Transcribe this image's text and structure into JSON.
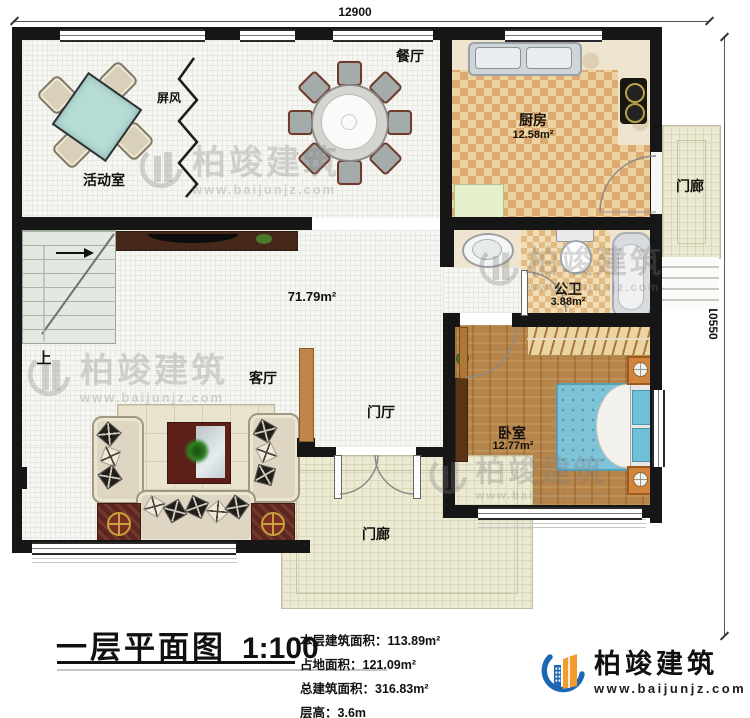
{
  "plan": {
    "title": "一层平面图",
    "scale": "1:100",
    "dimensions": {
      "top": "12900",
      "right": "10550"
    },
    "rooms": {
      "activity": {
        "label": "活动室"
      },
      "screen": {
        "label": "屏风"
      },
      "dining": {
        "label": "餐厅"
      },
      "kitchen": {
        "label": "厨房",
        "area": "12.58m²"
      },
      "porch_right": {
        "label": "门廊"
      },
      "bath": {
        "label": "公卫",
        "area": "3.88m²"
      },
      "bedroom": {
        "label": "卧室",
        "area": "12.77m²"
      },
      "living": {
        "label": "客厅"
      },
      "foyer": {
        "label": "门厅"
      },
      "porch_bottom": {
        "label": "门廊"
      },
      "stairs": {
        "label": "上"
      },
      "open_area": {
        "area": "71.79m²"
      }
    }
  },
  "footer": {
    "stats": [
      {
        "label": "本层建筑面积：",
        "value": "113.89m²"
      },
      {
        "label": "占地面积：",
        "value": "121.09m²"
      },
      {
        "label": "总建筑面积：",
        "value": "316.83m²"
      },
      {
        "label": "层高：",
        "value": "3.6m"
      }
    ]
  },
  "brand": {
    "name": "柏竣建筑",
    "url": "www.baijunjz.com"
  },
  "colors": {
    "wall": "#161616",
    "kitchen_floor": "#dcab72",
    "bedroom_floor": "#b5854b",
    "porch_floor": "#ecead3",
    "table_teal": "#b7dcd6",
    "brand_blue": "#1d67b5",
    "brand_orange": "#f29b2e",
    "watermark_gray": "rgba(122,122,122,0.3)"
  }
}
